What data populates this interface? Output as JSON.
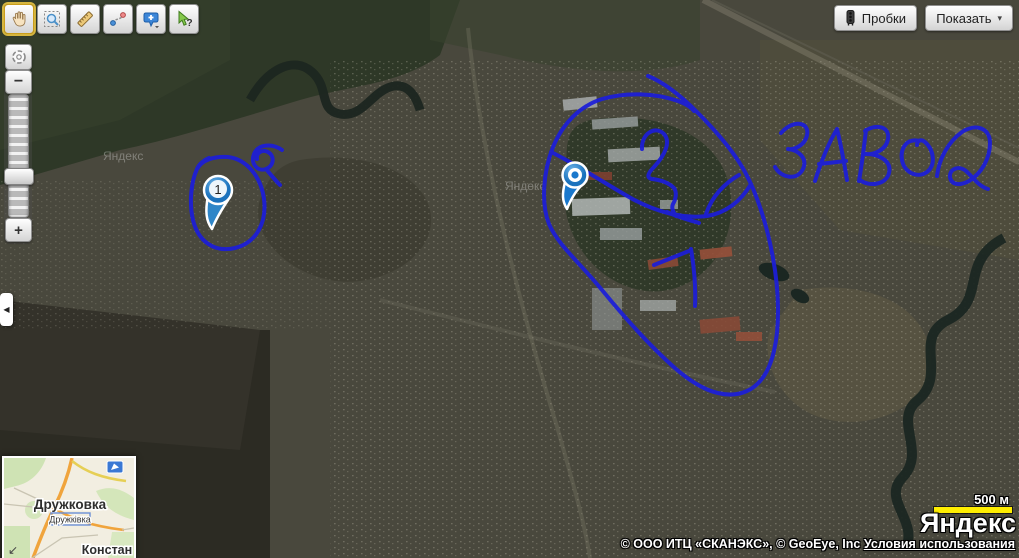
{
  "toolbar": {
    "icons": [
      "hand-icon",
      "zoom-select-icon",
      "ruler-icon",
      "route-icon",
      "balloon-plus-icon",
      "cursor-help-icon"
    ],
    "active_tool": "hand",
    "help_mark": "?"
  },
  "controls": {
    "traffic_label": "Пробки",
    "show_label": "Показать",
    "show_caret": "▾",
    "zoom_minus": "−",
    "zoom_plus": "+",
    "collapse_arrow": "◀"
  },
  "map": {
    "watermark": "Яндекс",
    "placemark_1_label": "1",
    "drawn_annotations": [
      "Я",
      "2",
      "1",
      "ЗАВОД"
    ],
    "annotation_color": "#1c1ed8",
    "markers": [
      {
        "type": "numbered-pin",
        "label": "1"
      },
      {
        "type": "plain-pin",
        "label": ""
      }
    ]
  },
  "minimap": {
    "city_name": "Дружковка",
    "city_name_uk": "Дружківка",
    "partial_city": "Констан",
    "resize_arrow": "↙",
    "pan_icon": "minimap-arrow-icon"
  },
  "scale": {
    "label": "500 м",
    "bar_color": "#ffee00"
  },
  "branding": {
    "logo": "Яндекс"
  },
  "attribution": {
    "copyright": "© ООО ИТЦ «СКАНЭКС», © GeoEye, Inc",
    "link": "Условия использования"
  }
}
